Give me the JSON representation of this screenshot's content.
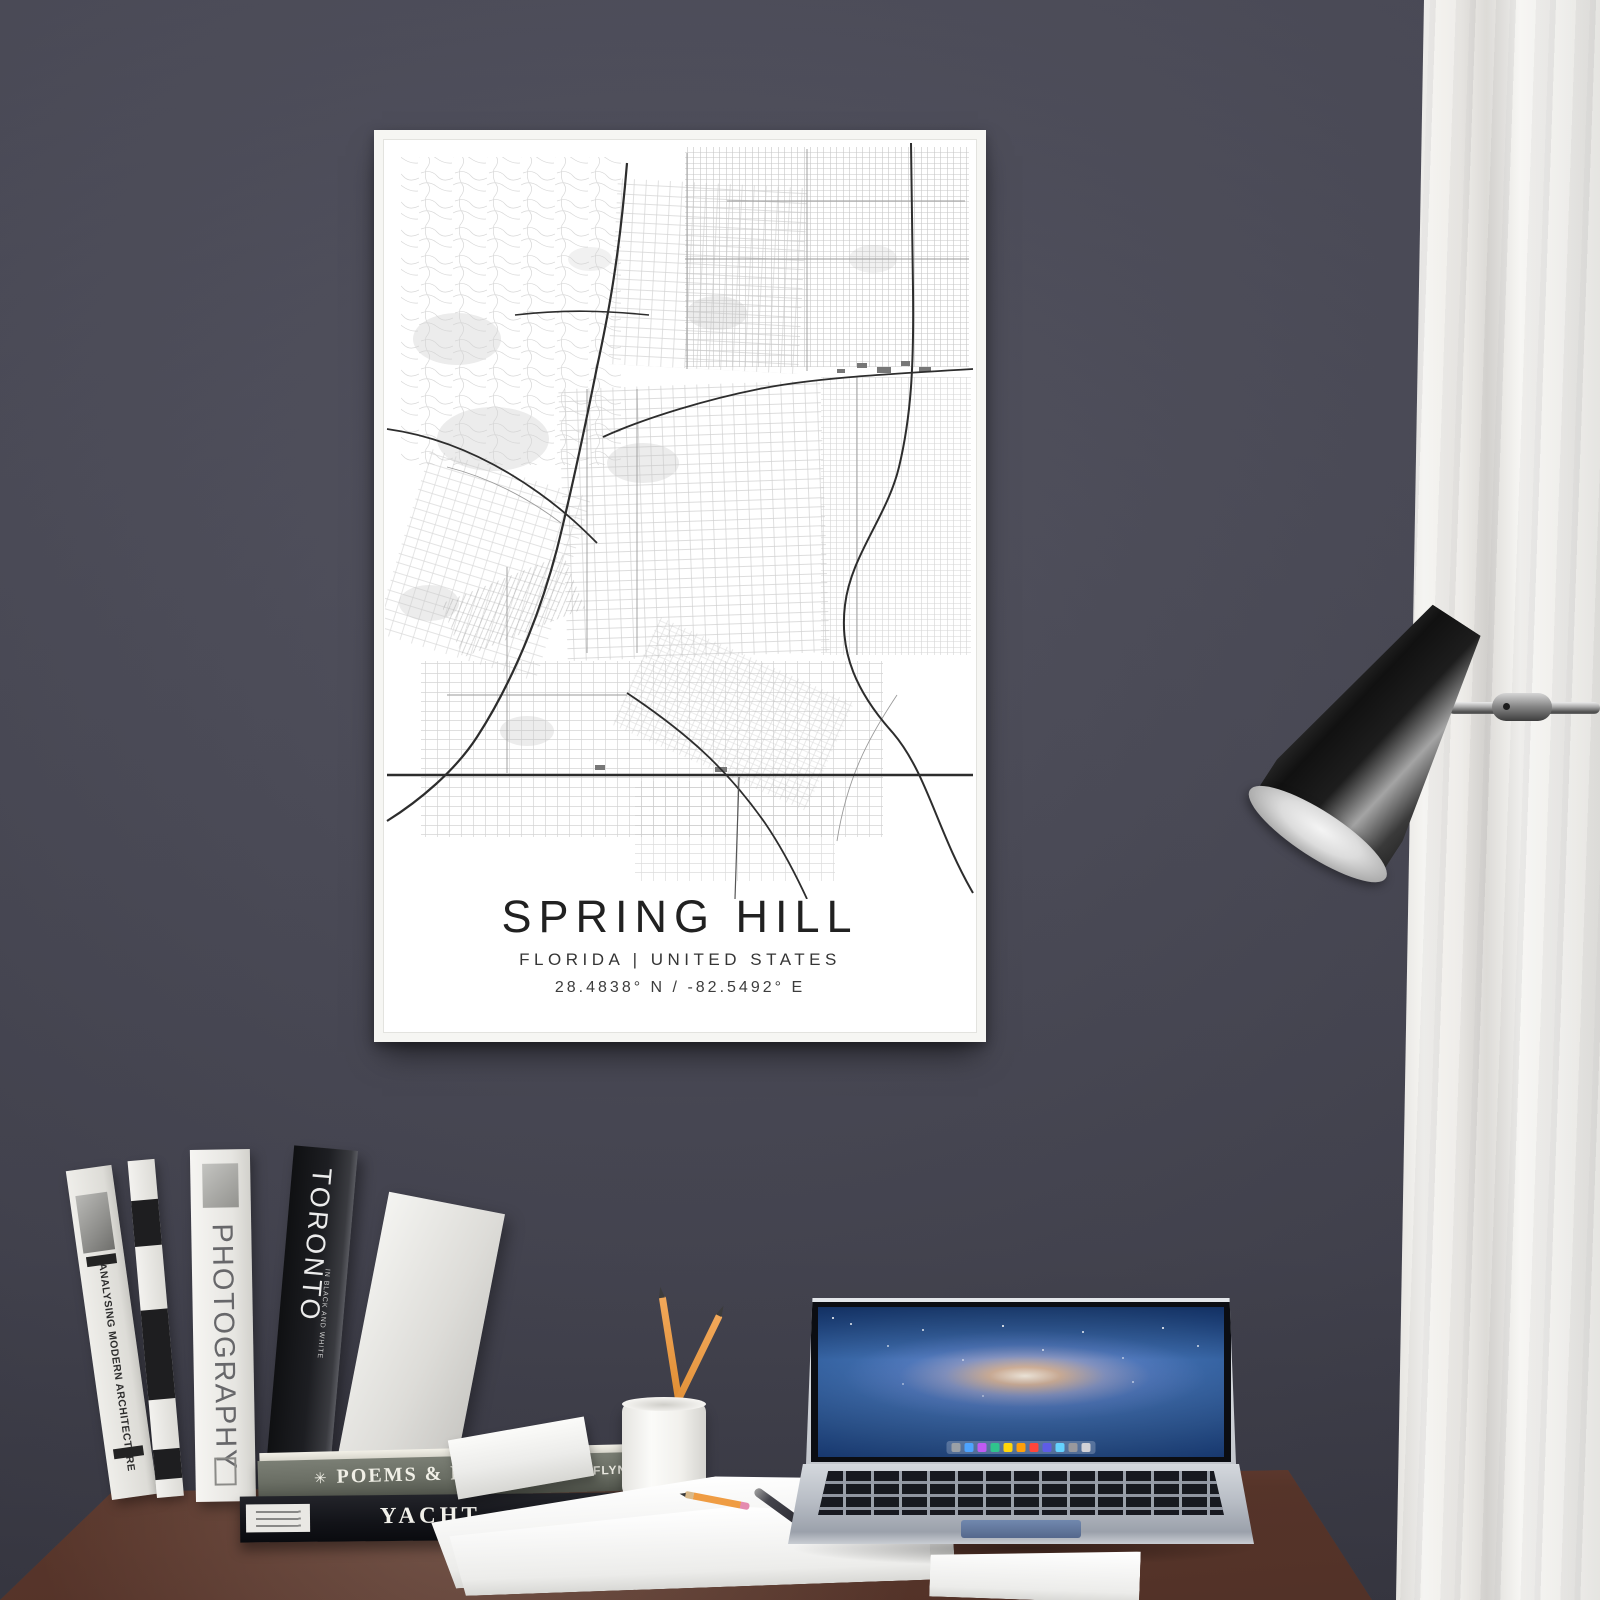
{
  "scene": {
    "wall_color": "#4a4a57",
    "desk_color": "#95604c",
    "curtain_color": "#f1f0ed",
    "frame_color": "#f6f6f3"
  },
  "poster": {
    "title": "SPRING HILL",
    "subtitle": "FLORIDA | UNITED STATES",
    "coordinates": "28.4838° N / -82.5492° E",
    "map_style": "black-and-white street map",
    "major_road_color": "#2d2d2d",
    "minor_road_color": "#c6c6c6"
  },
  "desk_items": {
    "books_vertical": [
      {
        "title": "ANALYSING MODERN ARCHITECTURE",
        "spine_color": "#efeeea"
      },
      {
        "title": "PHOTOGRAPHY",
        "spine_color": "#f6f5f2"
      },
      {
        "title": "TORONTO",
        "subtitle": "IN BLACK AND WHITE",
        "author": "STUART TELLER",
        "spine_color": "#1d1e22"
      }
    ],
    "books_horizontal": [
      {
        "icon_glyph": "✳",
        "title": "POEMS & PEOPLE",
        "author": "BEN FLYNN",
        "spine_color": "#6a6e64"
      },
      {
        "title": "YACHT",
        "subtitle": "A PHOTO JOURNAL",
        "spine_color": "#121318"
      }
    ],
    "pencil_cup": {
      "color": "#f1f0ec",
      "pencil_count": 2,
      "pencil_color": "#e8923a"
    },
    "laptop": {
      "style": "silver laptop with galaxy wallpaper",
      "dock_colors": [
        "#9aa0a6",
        "#4da3ff",
        "#bf5af2",
        "#30c48d",
        "#ffd60a",
        "#ff9f0a",
        "#ff453a",
        "#5e5ce6",
        "#64d2ff",
        "#98989d",
        "#d2d2d7"
      ]
    },
    "lamp": {
      "shade_color": "#1c1c1c",
      "arm_color": "#b9b9b9"
    }
  }
}
